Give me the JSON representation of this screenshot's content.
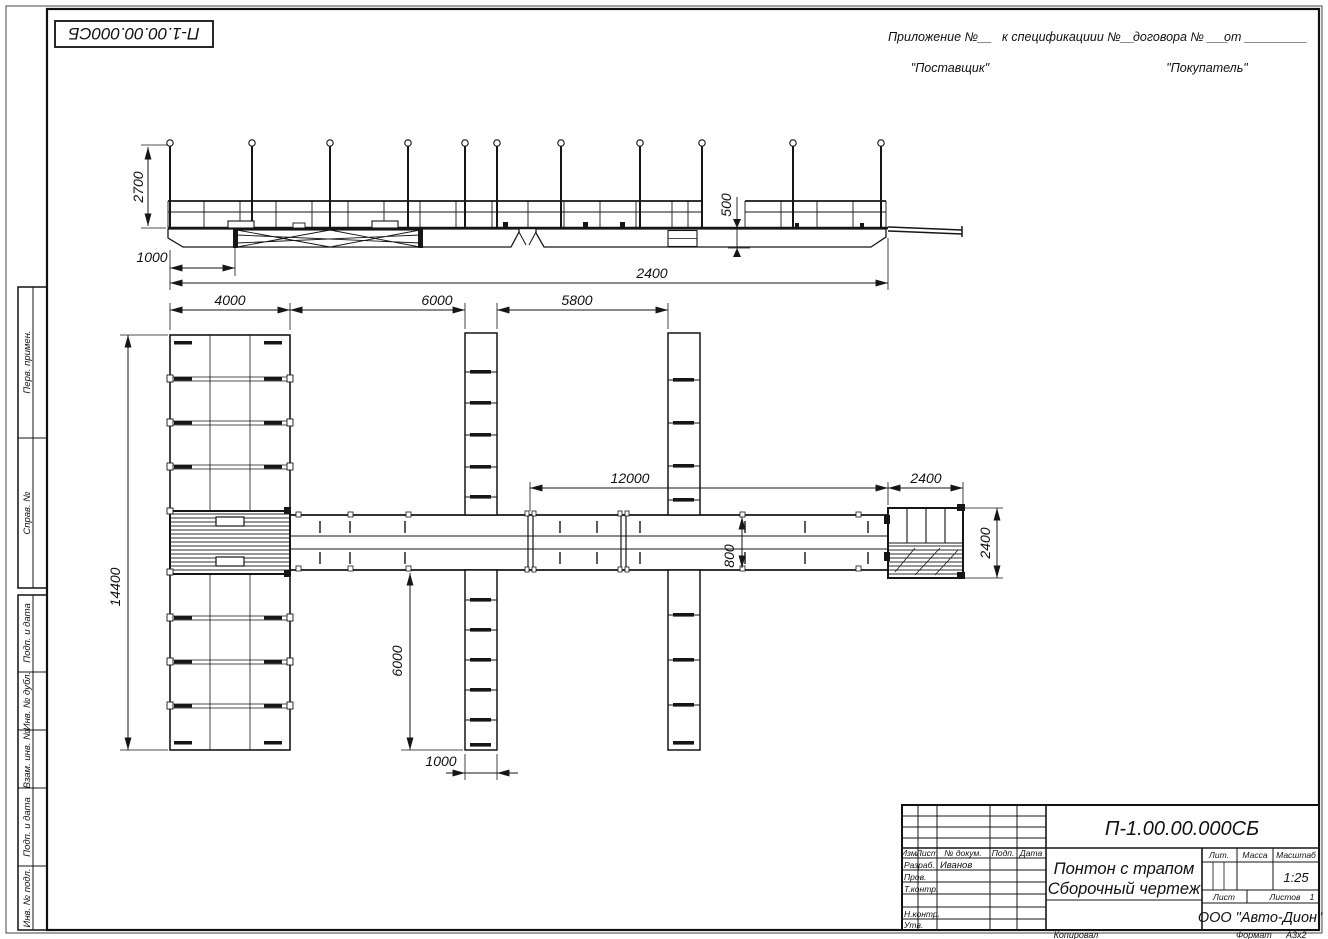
{
  "sheet": {
    "doc_number": "П-1.00.00.000СБ",
    "appendix": {
      "part1": "Приложение №__",
      "part2": "к спецификациии №__",
      "part3": "договора № ___",
      "part4": "от _________",
      "supplier": "\"Поставщик\"",
      "buyer": "\"Покупатель\""
    },
    "footer": {
      "copied": "Копировал",
      "format_label": "Формат",
      "format_value": "А3х2"
    }
  },
  "side_stamps": {
    "perv_primen": "Перв. примен.",
    "sprav_no": "Справ. №",
    "podp_data1": "Подп. и дата",
    "inv_dubl": "Инв. № дубл.",
    "vzam_inv": "Взам. инв. №",
    "podp_data2": "Подп. и дата",
    "inv_podl": "Инв. № подл."
  },
  "title_block": {
    "doc_number": "П-1.00.00.000СБ",
    "title_line1": "Понтон с трапом",
    "title_line2": "Сборочный чертеж",
    "company": "ООО \"Авто-Дион\"",
    "developer": "Иванов",
    "cols": {
      "izm": "Изм.",
      "list": "Лист",
      "doc": "№ докум.",
      "podp": "Подп.",
      "data": "Дата"
    },
    "rows": {
      "razrab": "Разраб.",
      "prov": "Пров.",
      "tkontr": "Т.контр.",
      "nkontr": "Н.контр.",
      "utv": "Утв."
    },
    "lit": "Лит.",
    "mass": "Масса",
    "scale_label": "Масштаб",
    "scale": "1:25",
    "sheet_label": "Лист",
    "sheets_label": "Листов",
    "sheets_count": "1"
  },
  "dimensions": {
    "side_post_height": "2700",
    "side_ramp_offset": "1000",
    "side_hull_height": "500",
    "side_total": "2400",
    "plan_pier_width": "4000",
    "plan_gap1": "6000",
    "plan_gap2": "5800",
    "plan_walkway_length": "12000",
    "plan_platform_length": "2400",
    "plan_pier_length": "14400",
    "plan_finger_length": "6000",
    "plan_finger_width": "1000",
    "plan_walkway_width": "800",
    "plan_platform_width": "2400"
  }
}
